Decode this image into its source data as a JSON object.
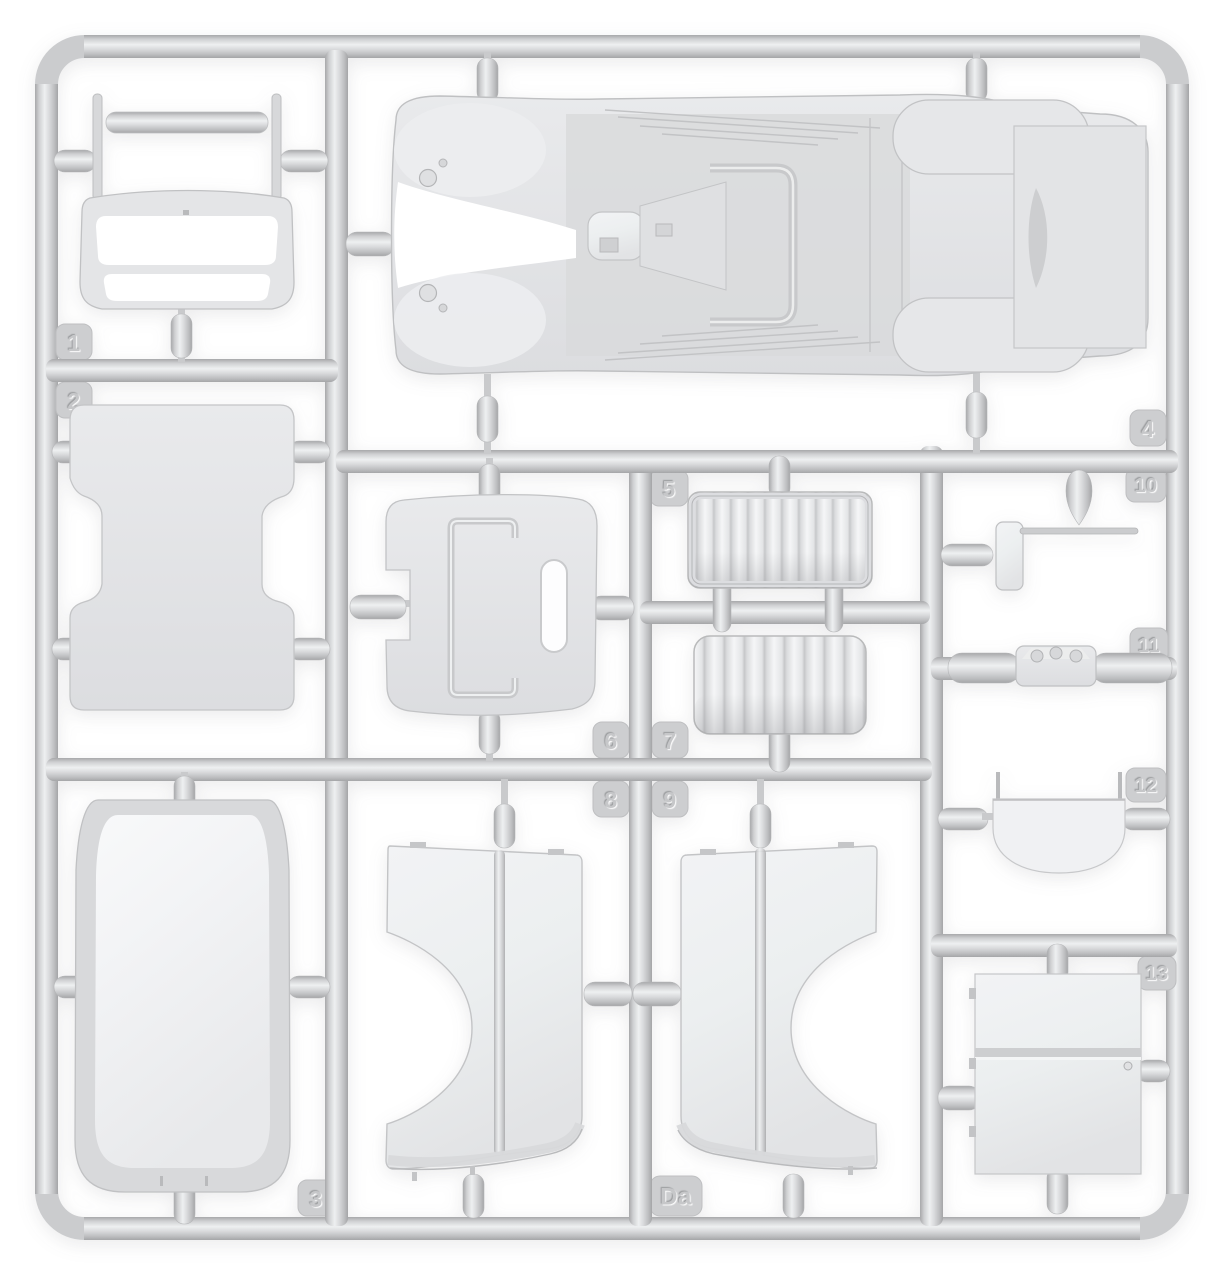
{
  "sprue": {
    "part_tags": [
      {
        "label": "1"
      },
      {
        "label": "2"
      },
      {
        "label": "3"
      },
      {
        "label": "4"
      },
      {
        "label": "5"
      },
      {
        "label": "6"
      },
      {
        "label": "7"
      },
      {
        "label": "8"
      },
      {
        "label": "9"
      },
      {
        "label": "10"
      },
      {
        "label": "11"
      },
      {
        "label": "12"
      },
      {
        "label": "13"
      },
      {
        "label": "Da"
      }
    ],
    "colors": {
      "background": "#ffffff",
      "plastic_base": "#d6d7d9",
      "plastic_highlight": "#f2f3f4",
      "plastic_shadow": "#a8a9ab",
      "part_fill": "#e9eaec",
      "tag_fill": "#cdced0",
      "tag_text": "#c6c7c9"
    }
  }
}
